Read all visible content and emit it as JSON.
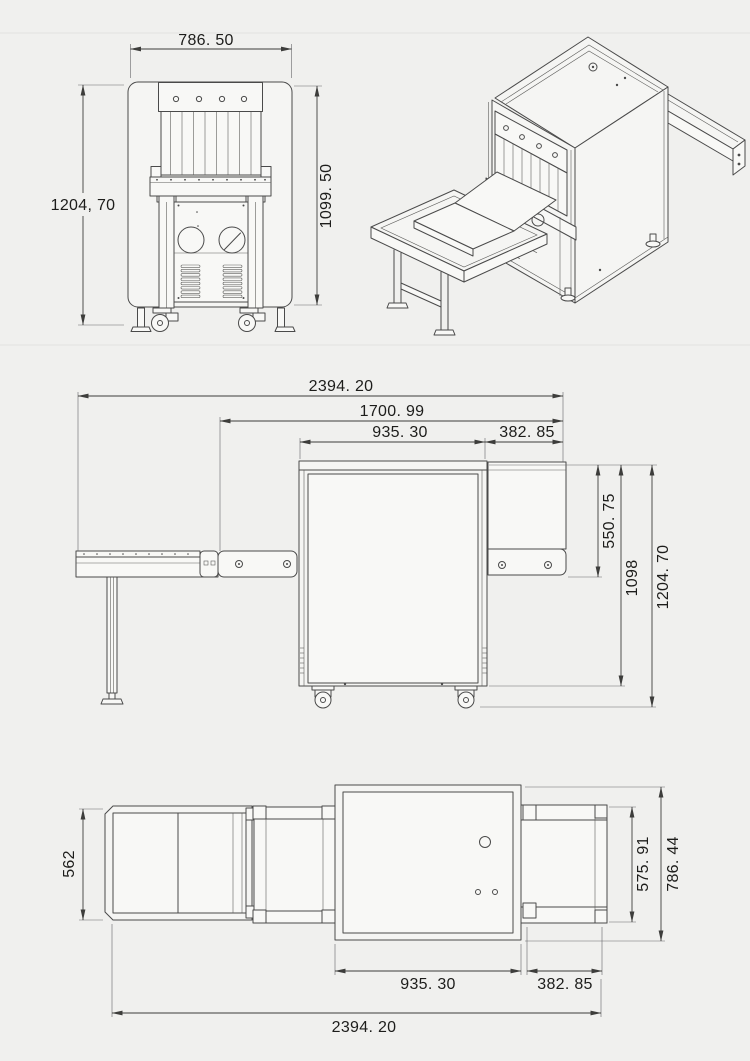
{
  "drawing": {
    "type": "technical-dimension-drawing",
    "subject": "x-ray-baggage-scanner",
    "background_color": "#f0f0ee",
    "line_color": "#4a4a4a",
    "text_color": "#1d1d1b",
    "views": {
      "front": {
        "label": "front-elevation",
        "dims": {
          "width": "786. 50",
          "height_left": "1204, 70",
          "height_right": "1099. 50"
        }
      },
      "isometric": {
        "label": "isometric-view"
      },
      "side": {
        "label": "side-elevation",
        "dims": {
          "total_length": "2394. 20",
          "conveyor_length": "1700. 99",
          "body_length": "935. 30",
          "exit_length": "382. 85",
          "tunnel_height": "550. 75",
          "body_height": "1098",
          "total_height": "1204. 70"
        }
      },
      "plan": {
        "label": "top-plan-view",
        "dims": {
          "entry_width": "562",
          "body_length": "935. 30",
          "exit_length": "382. 85",
          "total_length": "2394. 20",
          "exit_width": "575. 91",
          "body_width": "786. 44"
        }
      }
    }
  }
}
